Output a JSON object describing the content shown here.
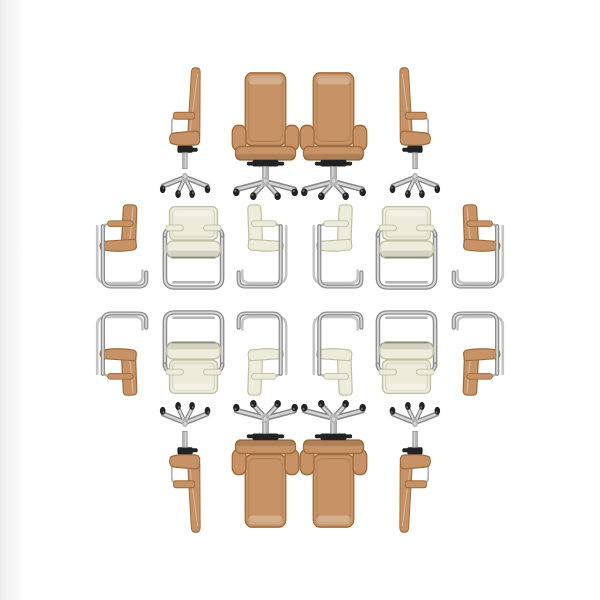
{
  "scene": {
    "title": "Mirrored collage of tan and cream office chairs on white background",
    "background_color": "#ffffff",
    "left_edge_shade_color": "#ececec",
    "symmetry": "horizontal mirror about x=300, vertical mirror about y=300"
  },
  "palette": {
    "tan": "#c79366",
    "tan_dark": "#9e6c3c",
    "cream": "#edebd9",
    "cream_dark": "#c2bfa3",
    "chrome": "#b5b5b5",
    "chrome_dark": "#8a8a8a",
    "chrome_light": "#d6d6d6",
    "hardware_black": "#222222"
  },
  "rows": [
    {
      "name": "top-row-swivel-chairs",
      "chairs": [
        {
          "kind": "office-side",
          "color": "tan",
          "x": 155,
          "y": 66,
          "w": 63,
          "h": 134,
          "flip_h": true,
          "flip_v": false
        },
        {
          "kind": "office-front",
          "color": "tan",
          "x": 229,
          "y": 70,
          "w": 73,
          "h": 130,
          "flip_h": false,
          "flip_v": false
        },
        {
          "kind": "office-front",
          "color": "tan",
          "x": 297,
          "y": 70,
          "w": 73,
          "h": 130,
          "flip_h": false,
          "flip_v": false
        },
        {
          "kind": "office-side",
          "color": "tan",
          "x": 382,
          "y": 66,
          "w": 63,
          "h": 134,
          "flip_h": false,
          "flip_v": false
        }
      ]
    },
    {
      "name": "upper-middle-row-cantilever-chairs",
      "chairs": [
        {
          "kind": "cant-side",
          "color": "tan",
          "x": 84,
          "y": 203,
          "w": 66,
          "h": 96,
          "flip_h": true,
          "flip_v": false
        },
        {
          "kind": "cant-front",
          "color": "cream",
          "x": 152,
          "y": 204,
          "w": 83,
          "h": 95,
          "flip_h": false,
          "flip_v": false
        },
        {
          "kind": "cant-side",
          "color": "cream",
          "x": 235,
          "y": 203,
          "w": 64,
          "h": 96,
          "flip_h": false,
          "flip_v": false
        },
        {
          "kind": "cant-side",
          "color": "cream",
          "x": 301,
          "y": 203,
          "w": 64,
          "h": 96,
          "flip_h": true,
          "flip_v": false
        },
        {
          "kind": "cant-front",
          "color": "cream",
          "x": 365,
          "y": 204,
          "w": 83,
          "h": 95,
          "flip_h": false,
          "flip_v": false
        },
        {
          "kind": "cant-side",
          "color": "tan",
          "x": 450,
          "y": 203,
          "w": 66,
          "h": 96,
          "flip_h": false,
          "flip_v": false
        }
      ]
    },
    {
      "name": "lower-middle-row-cantilever-chairs-reflected",
      "chairs": [
        {
          "kind": "cant-side",
          "color": "tan",
          "x": 84,
          "y": 301,
          "w": 66,
          "h": 96,
          "flip_h": true,
          "flip_v": true
        },
        {
          "kind": "cant-front",
          "color": "cream",
          "x": 152,
          "y": 301,
          "w": 83,
          "h": 95,
          "flip_h": false,
          "flip_v": true
        },
        {
          "kind": "cant-side",
          "color": "cream",
          "x": 235,
          "y": 301,
          "w": 64,
          "h": 96,
          "flip_h": false,
          "flip_v": true
        },
        {
          "kind": "cant-side",
          "color": "cream",
          "x": 301,
          "y": 301,
          "w": 64,
          "h": 96,
          "flip_h": true,
          "flip_v": true
        },
        {
          "kind": "cant-front",
          "color": "cream",
          "x": 365,
          "y": 301,
          "w": 83,
          "h": 95,
          "flip_h": false,
          "flip_v": true
        },
        {
          "kind": "cant-side",
          "color": "tan",
          "x": 450,
          "y": 301,
          "w": 66,
          "h": 96,
          "flip_h": false,
          "flip_v": true
        }
      ]
    },
    {
      "name": "bottom-row-swivel-chairs-reflected",
      "chairs": [
        {
          "kind": "office-side",
          "color": "tan",
          "x": 155,
          "y": 400,
          "w": 63,
          "h": 134,
          "flip_h": true,
          "flip_v": true
        },
        {
          "kind": "office-front",
          "color": "tan",
          "x": 229,
          "y": 400,
          "w": 73,
          "h": 130,
          "flip_h": false,
          "flip_v": true
        },
        {
          "kind": "office-front",
          "color": "tan",
          "x": 297,
          "y": 400,
          "w": 73,
          "h": 130,
          "flip_h": false,
          "flip_v": true
        },
        {
          "kind": "office-side",
          "color": "tan",
          "x": 382,
          "y": 400,
          "w": 63,
          "h": 134,
          "flip_h": false,
          "flip_v": true
        }
      ]
    }
  ]
}
